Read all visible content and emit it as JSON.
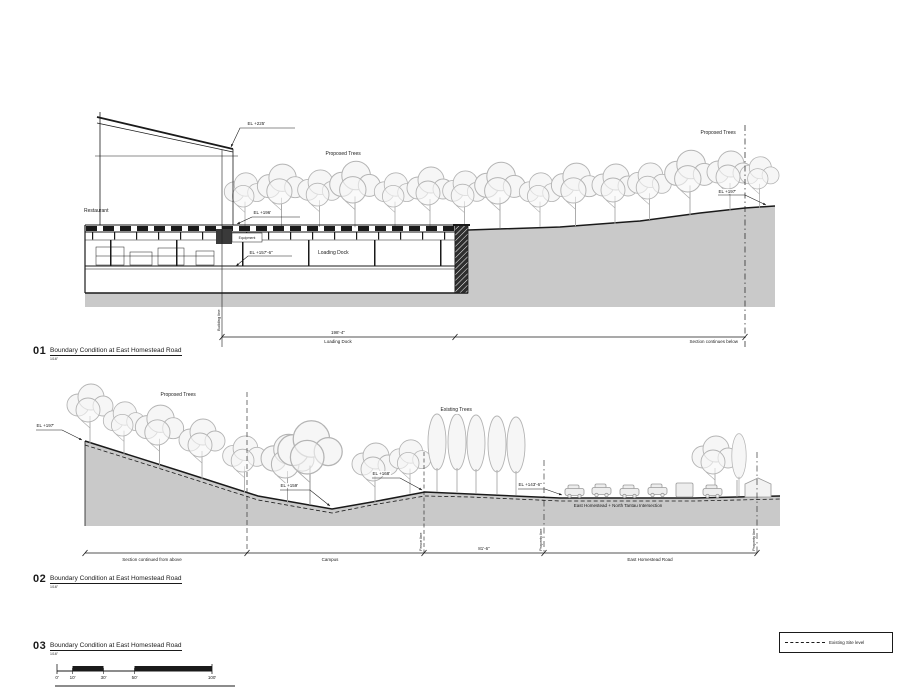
{
  "colors": {
    "ground": "#c9c9c9",
    "tree_stroke": "#b4b4b4",
    "line": "#1a1a1a"
  },
  "drawing01": {
    "number": "01",
    "title": "Boundary Condition at East Homestead Road",
    "scale": "1/16\"",
    "labels": {
      "restaurant": "Restaurant",
      "proposed_trees": "Proposed Trees",
      "el_roof": "EL +225'",
      "el_plaza": "EL +196'",
      "equipment": "Equipment",
      "el_dock": "EL +157'-6\"",
      "loading_dock_room": "Loading Dock",
      "el_grade_right": "EL +197'",
      "building_line": "Building line",
      "dim_length": "198'-4\"",
      "dim_caption": "Loading Dock",
      "section_note": "Section continues below"
    }
  },
  "drawing02": {
    "number": "02",
    "title": "Boundary Condition at East Homestead Road",
    "scale": "1/16\"",
    "labels": {
      "proposed_trees": "Proposed Trees",
      "existing_trees": "Existing Trees",
      "el_left": "EL +197'",
      "el_dip": "EL +159'",
      "el_knoll": "EL +168'",
      "el_road": "EL +143'-6\"",
      "intersection": "East Homestead + North Tantau Intersection",
      "fence_line": "Fence line",
      "property_line": "Property line",
      "dim_road": "81'-6\"",
      "seg_continued": "Section continued from above",
      "seg_campus": "Campus",
      "seg_road": "East Homestead Road"
    }
  },
  "drawing03": {
    "number": "03",
    "title": "Boundary Condition at East Homestead Road",
    "scale": "1/16\""
  },
  "legend": {
    "existing_site_level": "Existing Site level"
  },
  "scale_bar": {
    "ticks": [
      "0'",
      "10'",
      "30'",
      "50'",
      "100'"
    ]
  }
}
